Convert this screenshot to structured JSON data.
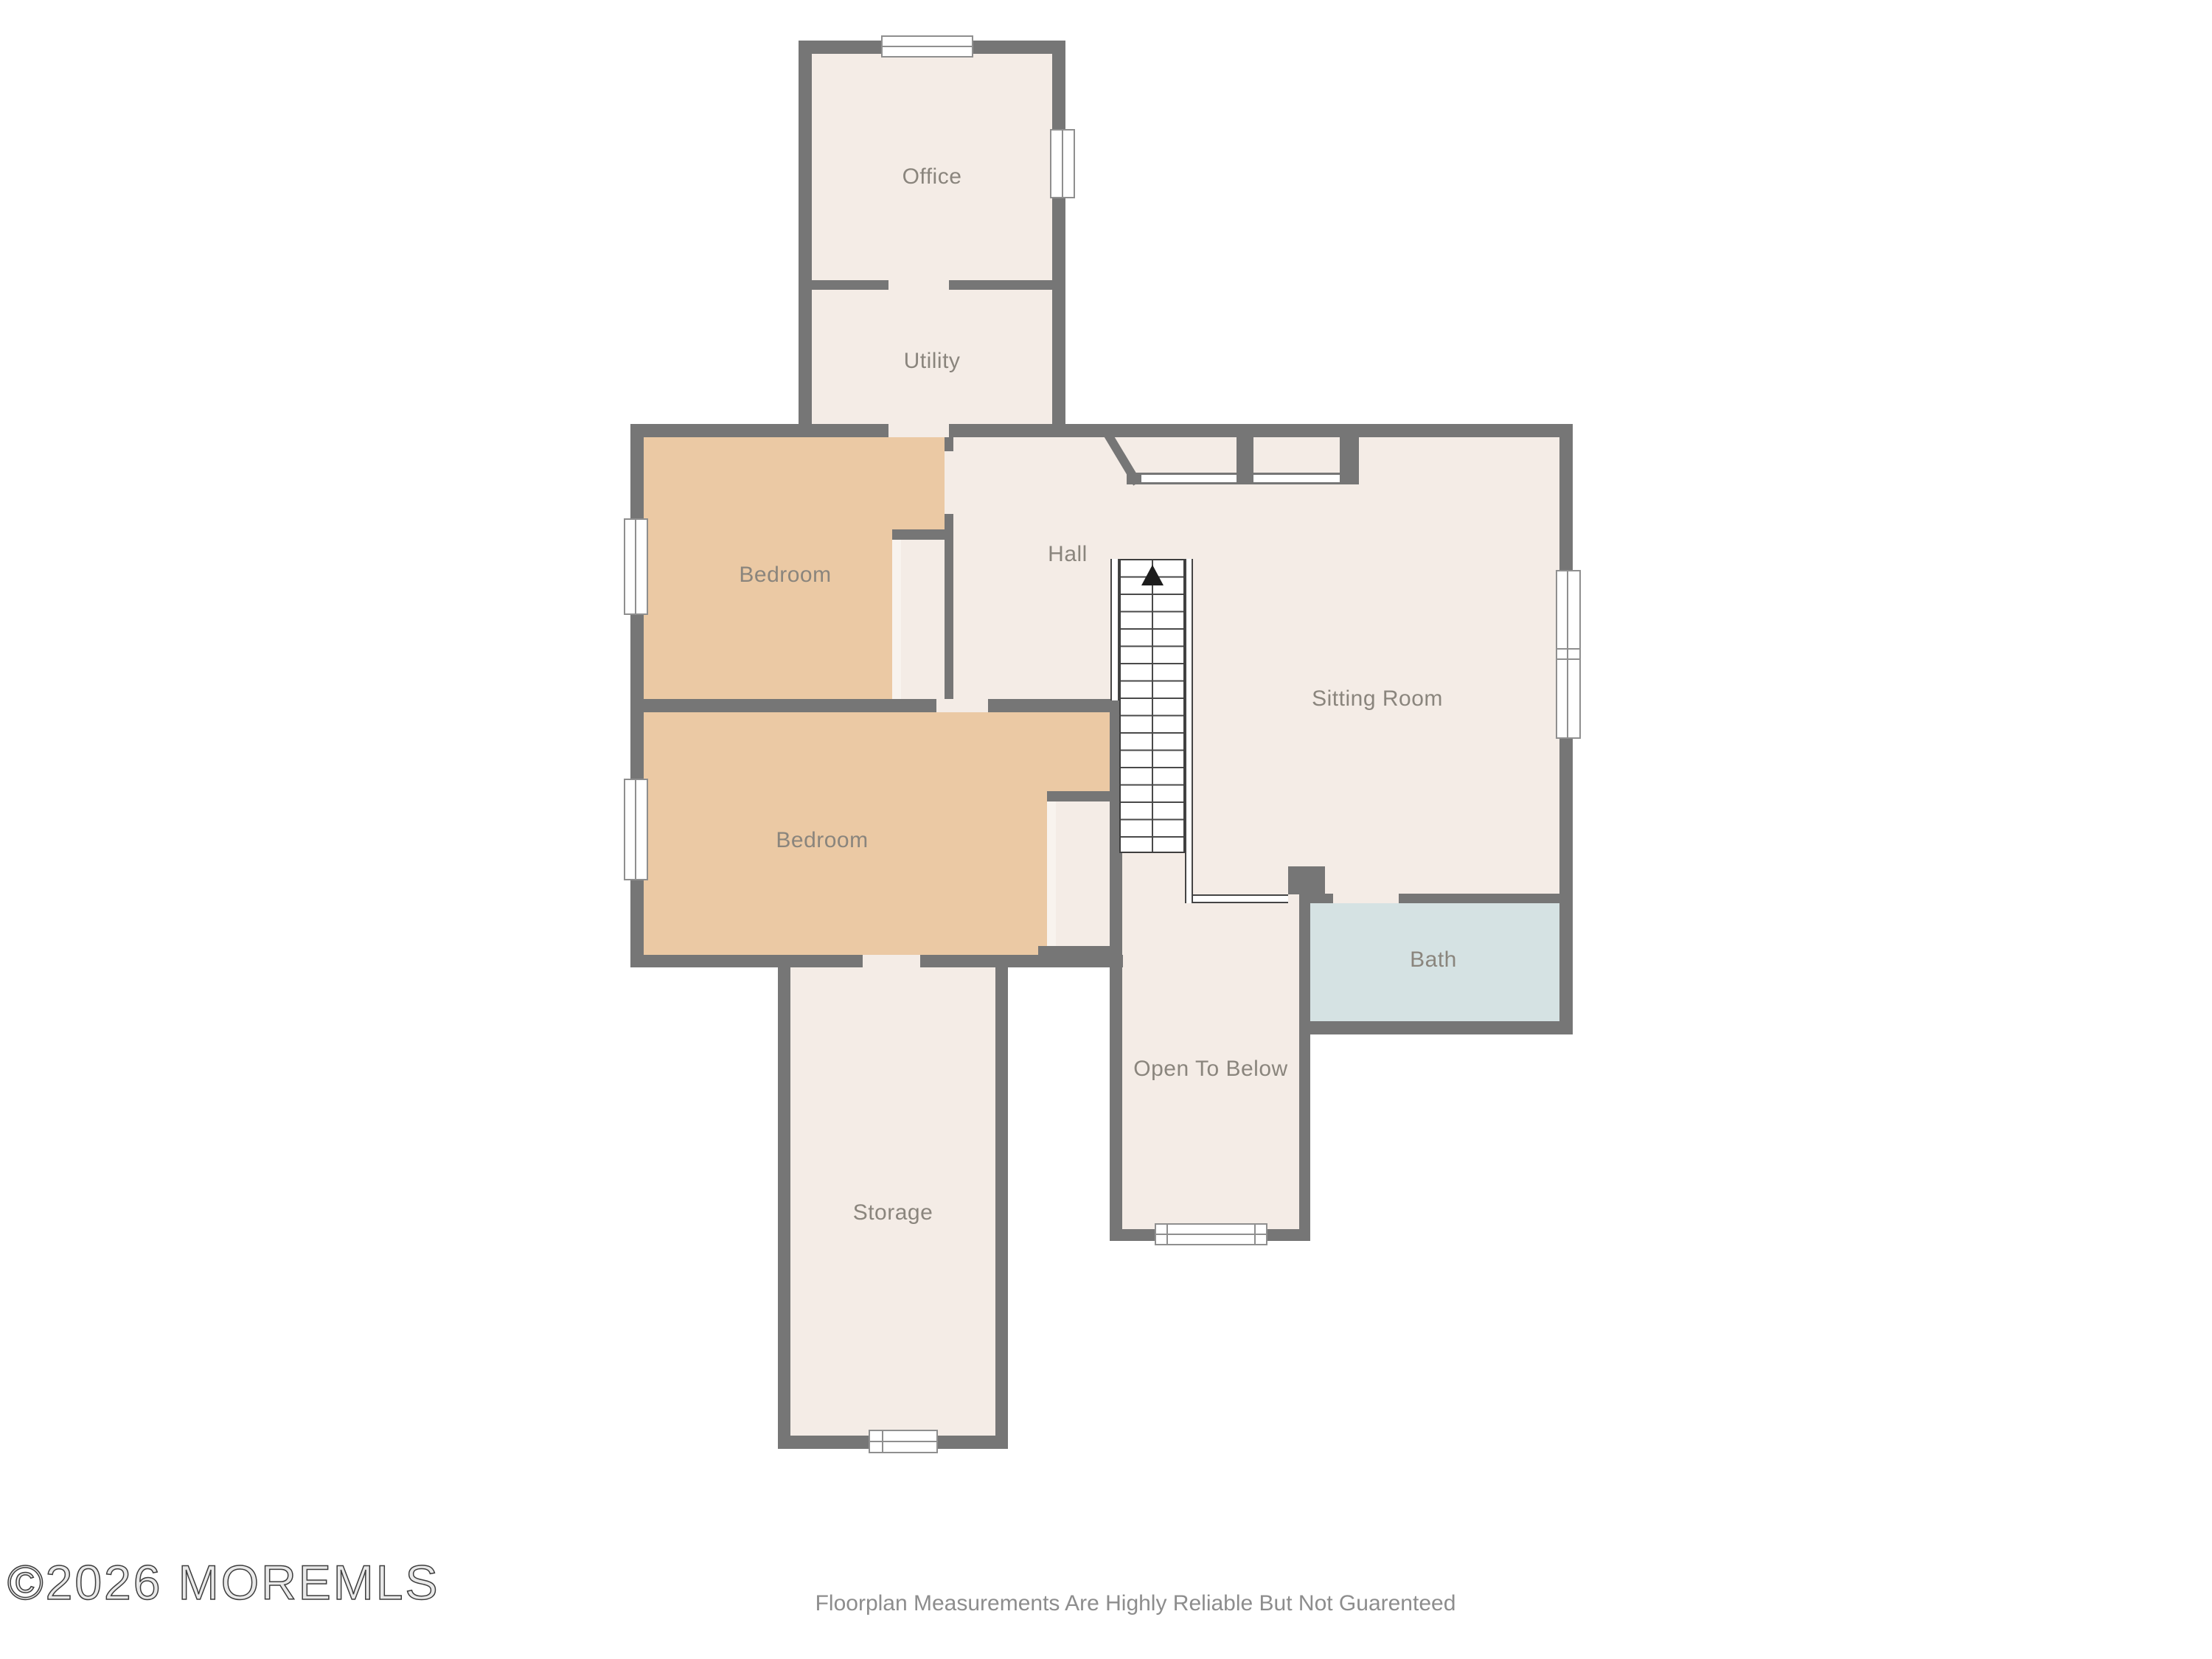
{
  "title": "Residential floorplan - upper level",
  "rooms": {
    "office": {
      "label": "Office"
    },
    "utility": {
      "label": "Utility"
    },
    "bedroom1": {
      "label": "Bedroom"
    },
    "bedroom2": {
      "label": "Bedroom"
    },
    "hall": {
      "label": "Hall"
    },
    "sitting_room": {
      "label": "Sitting Room"
    },
    "bath": {
      "label": "Bath"
    },
    "open_to_below": {
      "label": "Open To Below"
    },
    "storage": {
      "label": "Storage"
    }
  },
  "stairs": {
    "direction": "up",
    "symbol": "up-arrow"
  },
  "footer": {
    "watermark": "©2026 MOREMLS",
    "disclaimer": "Floorplan Measurements Are Highly Reliable But Not Guarenteed"
  },
  "colors": {
    "wall": "#767676",
    "floor_cream": "#f4ece6",
    "bedroom_tan": "#ebc9a4",
    "bath_blue": "#d5e2e3",
    "label_text": "#8a857d",
    "background": "#ffffff"
  }
}
